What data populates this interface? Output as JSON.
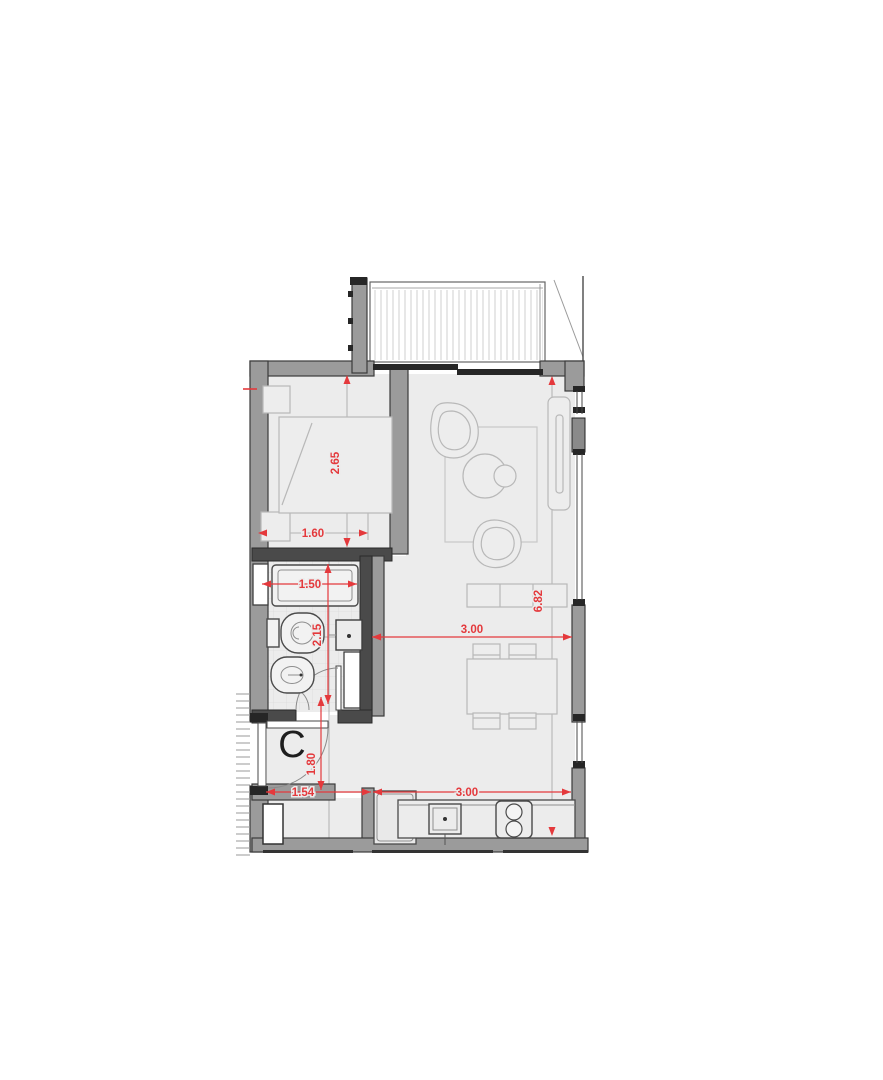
{
  "plan": {
    "unit_label": "C",
    "dimensions": {
      "bedroom_depth": "2.65",
      "bedroom_width": "1.60",
      "shower_width": "1.50",
      "bathroom_depth": "2.15",
      "living_width": "3.00",
      "unit_depth": "6.82",
      "entry_depth": "1.80",
      "entry_width": "1.54",
      "kitchen_width": "3.00"
    },
    "colors": {
      "dimension_red": "#e4393c",
      "wall_fill": "#9b9b9b",
      "wall_dark": "#4a4a4a",
      "floor_fill": "#ececec"
    }
  }
}
